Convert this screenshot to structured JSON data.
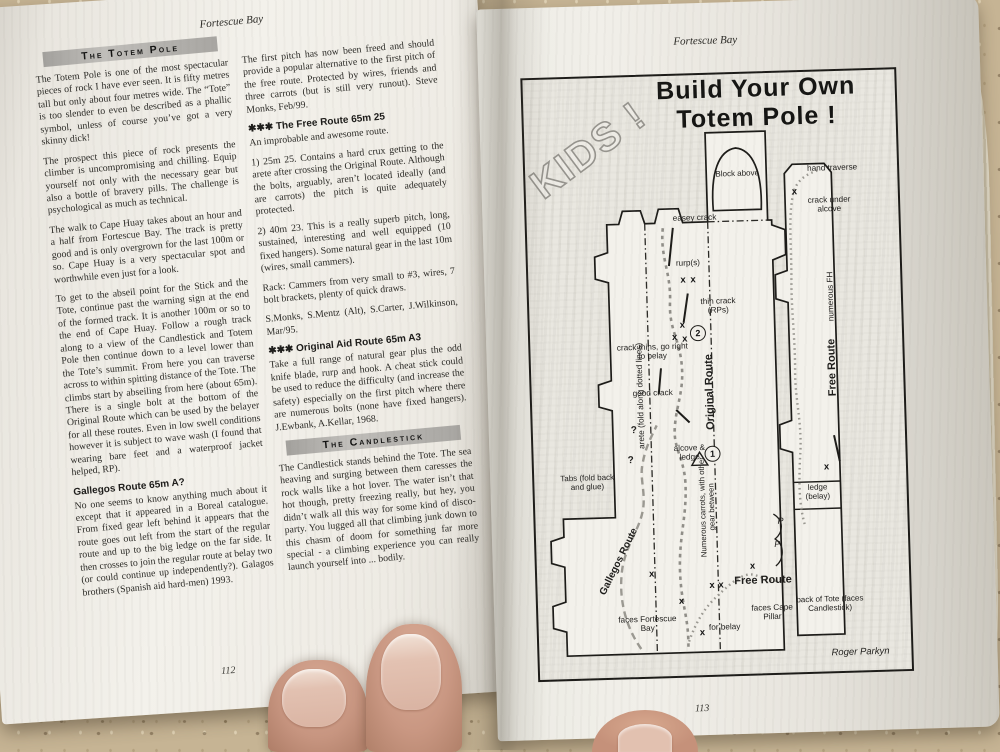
{
  "left_page": {
    "header": "Fortescue Bay",
    "page_number": "112",
    "totem_bar": "The Totem Pole",
    "col1_paras": [
      "The Totem Pole is one of the most spectacular pieces of rock I have ever seen. It is fifty metres tall but only about four metres wide. The “Tote” is too slender to even be described as a phallic symbol, unless of course you’ve got a very skinny dick!",
      "The prospect this piece of rock presents the climber is uncompromising and chilling. Equip yourself not only with the necessary gear but also a bottle of bravery pills. The challenge is psychological as much as technical.",
      "The walk to Cape Huay takes about an hour and a half from Fortescue Bay. The track is pretty good and is only overgrown for the last 100m or so. Cape Huay is a very spectacular spot and worthwhile even just for a look.",
      "To get to the abseil point for the Stick and the Tote, continue past the warning sign at the end of the formed track. It is another 100m or so to the end of Cape Huay. Follow a rough track along to a view of the Candlestick and Totem Pole then continue down to a level lower than the Tote’s summit. From here you can traverse across to within spitting distance of the Tote. The climbs start by abseiling from here (about 65m). There is a single bolt at the bottom of the Original Route which can be used by the belayer for all these routes. Even in low swell conditions however it is subject to wave wash (I found that wearing bare feet and a waterproof jacket helped, RP)."
    ],
    "gallegos_heading": "Gallegos Route 65m A?",
    "gallegos_para": "No one seems to know anything much about it except that it appeared in a Boreal catalogue. From fixed gear left behind it appears that the route goes out left from the start of the regular route and up to the big ledge on the far side. It then crosses to join the regular route at belay two (or could continue up independently?). Galagos brothers (Spanish aid hard-men) 1993.",
    "col2_intro": "The first pitch has now been freed and should provide a popular alternative to the first pitch of the free route. Protected by wires, friends and three carrots (but is still very runout). Steve Monks, Feb/99.",
    "free_heading": "✱✱✱ The Free Route 65m 25",
    "free_paras": [
      "An improbable and awesome route.",
      "1) 25m 25. Contains a hard crux getting to the arete after crossing the Original Route. Although the bolts, arguably, aren’t located ideally (and are carrots) the pitch is quite adequately protected.",
      "2) 40m 23. This is a really superb pitch, long, sustained, interesting and well equipped (10 fixed hangers). Some natural gear in the last 10m (wires, small cammers).",
      "Rack: Cammers from very small to #3, wires, 7 bolt brackets, plenty of quick draws.",
      "S.Monks, S.Mentz (Alt), S.Carter, J.Wilkinson, Mar/95."
    ],
    "aid_heading": "✱✱✱ Original Aid Route 65m A3",
    "aid_para": "Take a full range of natural gear plus the odd knife blade, rurp and hook. A cheat stick could be used to reduce the difficulty (and increase the safety) especially on the first pitch where there are numerous bolts (none have fixed hangers). J.Ewbank, A.Kellar, 1968.",
    "candlestick_bar": "The Candlestick",
    "candlestick_para": "The Candlestick stands behind the Tote. The sea heaving and surging between them caresses the rock walls like a hot lover. The water isn’t that hot though, pretty freezing really, but hey, you didn’t walk all this way for some kind of disco-party. You lugged all that climbing junk down to this chasm of doom for something far more special - a climbing experience you can really launch yourself into ... bodily."
  },
  "right_page": {
    "header": "Fortescue Bay",
    "page_number": "113",
    "diagram": {
      "kids": "KIDS !",
      "title_line1": "Build Your Own",
      "title_line2": "Totem Pole !",
      "credit": "Roger Parkyn",
      "belay1": "1",
      "belay2": "2",
      "marker_glyph": "x",
      "question_glyph": "?",
      "piton_glyph": "P",
      "labels": {
        "block_above": "Block above",
        "hand_traverse": "hand traverse",
        "crack_under_alcove": "crack under alcove",
        "numerous_fh": "numerous FH",
        "free_route_vertical": "Free Route",
        "ledge_belay": "ledge (belay)",
        "back_of_tote": "back of Tote (faces Candlestick)",
        "arete_fold": "arete (fold along dotted lines)",
        "easey_crack": "easey crack",
        "rurps": "rurp(s)",
        "thin_crack_rps": "thin crack (RPs)",
        "crack_thins": "crack thins, go right to belay",
        "good_crack": "good crack",
        "original_route": "Original Route",
        "alcove_ledge": "alcove & ledge",
        "numerous_carrots": "Numerous carrots, with other gear between",
        "tabs_fold": "Tabs (fold back and glue)",
        "gallegos_route": "Gallegos Route",
        "faces_fortescue_bay": "faces Fortescue Bay",
        "for_belay": "for belay",
        "free_route_horizontal": "Free Route",
        "faces_cape_pillar": "faces Cape Pillar"
      }
    }
  }
}
